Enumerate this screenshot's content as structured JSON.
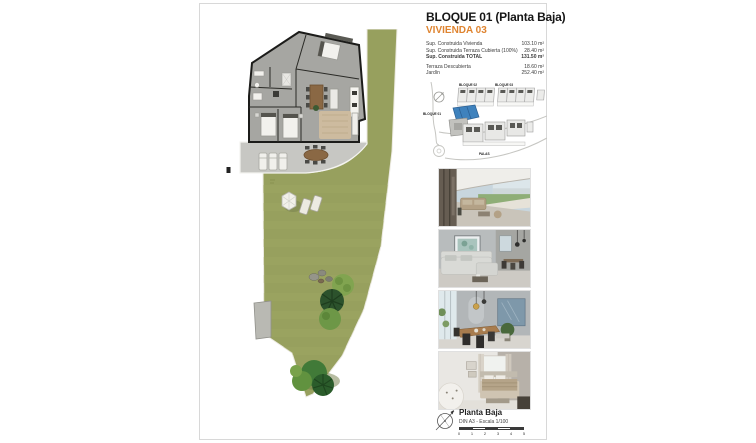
{
  "page": {
    "header": {
      "title": "BLOQUE 01 (Planta Baja)",
      "subtitle": "VIVIENDA 03"
    },
    "areas": {
      "rows": [
        {
          "label": "Sup. Construida Vivienda",
          "value": "103.10 m²"
        },
        {
          "label": "Sup. Construida Terraza Cubierta (100%)",
          "value": "28.40 m²"
        },
        {
          "label": "Sup. Construida TOTAL",
          "value": "131.50 m²"
        },
        {
          "label": "Terraza Descubierta",
          "value": "18.60 m²"
        },
        {
          "label": "Jardín",
          "value": "252.40 m²"
        }
      ]
    },
    "site_plan": {
      "labels": {
        "block2": "BLOQUE 02",
        "block3": "BLOQUE 03",
        "block1": "BLOQUE 01",
        "street": "PALAS"
      }
    },
    "photos": [
      {
        "name": "terrace-exterior-render"
      },
      {
        "name": "living-room-render"
      },
      {
        "name": "dining-room-render"
      },
      {
        "name": "bedroom-render"
      }
    ],
    "footer": {
      "plan_name": "Planta Baja",
      "scale_note": "DIN A3 - Escala 1/100",
      "scale_ticks": [
        "0",
        "1",
        "2",
        "3",
        "4",
        "5"
      ]
    }
  },
  "colors": {
    "accent_orange": "#DF8430",
    "garden_green": "#97A05E",
    "highlight_blue": "#3F82BD"
  }
}
